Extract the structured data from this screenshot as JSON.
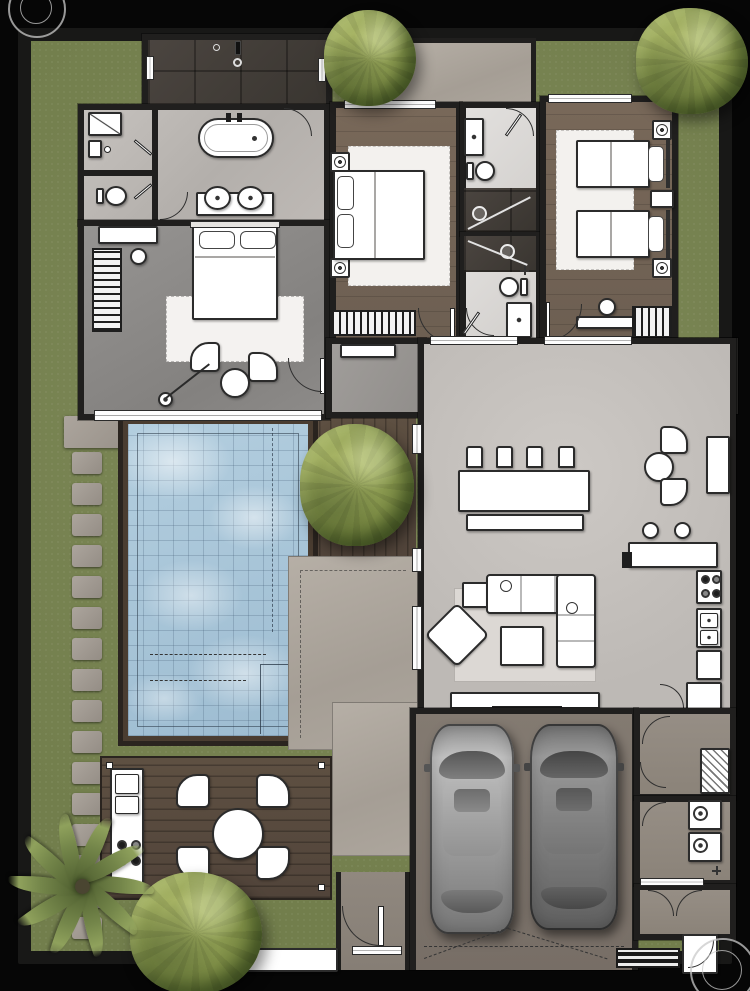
{
  "scene": {
    "type": "architectural-floor-plan",
    "view": "top-down-render",
    "width_px": 750,
    "height_px": 991
  },
  "palette": {
    "backdrop": "#060606",
    "lawn": "#7b8656",
    "wall": "#201f1e",
    "marble": "#c2beba",
    "bathm": "#dcd9d6",
    "darktile": "#433e39",
    "bedgray": "#8f8d8a",
    "wood": "#76675b",
    "living": "#c6c2be",
    "foyer": "#8b8177",
    "garage": "#7f766d",
    "utility": "#948c83",
    "water": "#a9c6da",
    "poolframe": "#4a3d31",
    "deck": "#5b4d40",
    "patio": "#b0a9a0",
    "stonep": "#a59e96",
    "fw": "#ffffff",
    "ol": "#2b2b2b",
    "tree": "#8b9a50"
  },
  "rooms": [
    {
      "id": "walk-in-shower"
    },
    {
      "id": "master-bathroom"
    },
    {
      "id": "powder-wc"
    },
    {
      "id": "master-bedroom"
    },
    {
      "id": "bedroom-2"
    },
    {
      "id": "bathroom-2"
    },
    {
      "id": "bathroom-3"
    },
    {
      "id": "bedroom-3"
    },
    {
      "id": "entry-foyer"
    },
    {
      "id": "hallway"
    },
    {
      "id": "living-dining-kitchen"
    },
    {
      "id": "garage"
    },
    {
      "id": "utility-hall"
    },
    {
      "id": "laundry"
    },
    {
      "id": "rear-porch"
    }
  ],
  "outdoor": [
    {
      "id": "swimming-pool"
    },
    {
      "id": "timber-deck-east"
    },
    {
      "id": "stone-patio"
    },
    {
      "id": "outdoor-kitchen-deck"
    },
    {
      "id": "stepping-stone-path"
    },
    {
      "id": "front-walkway"
    },
    {
      "id": "north-terrace"
    },
    {
      "id": "garden-lawn"
    }
  ],
  "inventory": {
    "double_beds": 2,
    "twin_beds": 2,
    "bathtubs": 1,
    "showers": 3,
    "toilets": 3,
    "vanity_sinks": 5,
    "dining_chairs": 4,
    "dining_bench": 1,
    "breakfast_chairs": 2,
    "bar_stools": 2,
    "sofa_sections": 2,
    "armchairs": 1,
    "lounge_chairs": 2,
    "outdoor_chairs": 4,
    "cars": 2,
    "round_trees": 4,
    "palm_trees": 1,
    "stepping_stones": 16,
    "washer_dryer_units": 2,
    "cooktop_burners": 4
  }
}
